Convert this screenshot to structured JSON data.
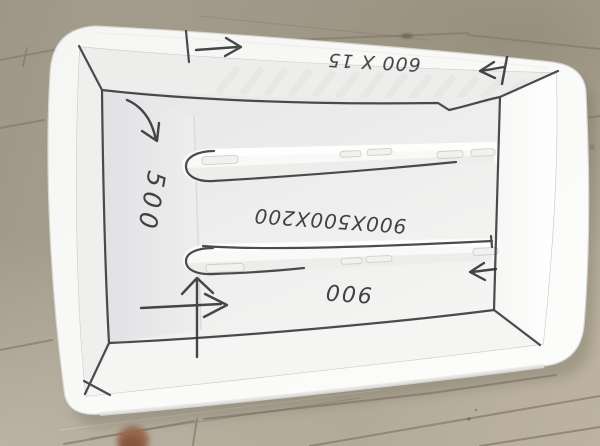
{
  "photo": {
    "annotations": {
      "rim_top": "600 X 15",
      "left_wall": "500",
      "floor_center": "900X500X200",
      "floor_bottom": "900"
    },
    "icons": {
      "rim_arrow_right": "→",
      "rim_arrow_left": "←",
      "wall_arrow_down": "↘",
      "floor_crosshair": "↑→",
      "right_wall_arrow_left": "←"
    },
    "colors": {
      "plastic_white": "#f8f8f6",
      "marker_ink": "#2e2d30",
      "wood_light": "#b9b09c",
      "wood_dark": "#857c6c"
    }
  }
}
